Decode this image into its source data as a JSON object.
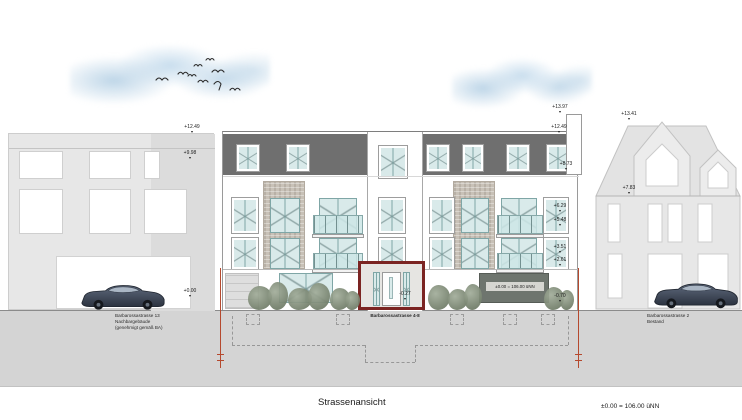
{
  "drawing": {
    "title": "Strassenansicht",
    "datum_note": "±0.00 = 106.00 üNN"
  },
  "neighbor_left": {
    "caption_line1": "Barbarossastrasse 13",
    "caption_line2": "Nachbargebäude",
    "caption_line3": "(genehmigt gemäß BA)",
    "marks": {
      "roof": "+12.49",
      "eave": "+9.98",
      "street": "+0.00"
    }
  },
  "main_building": {
    "caption": "Barbarossastrasse 4-8",
    "ground_floor_datum": "±0.00 = 106.00 üNN",
    "marks": {
      "shaft_top": "+13.97",
      "roof_parapet": "+12.49",
      "attic_eave": "+8.73",
      "window_upper_head": "+6.29",
      "window_upper_sill": "+5.48",
      "window_lower_head": "+3.51",
      "window_lower_sill": "+2.61",
      "base": "-0.70",
      "entrance": "-0.27"
    }
  },
  "neighbor_right": {
    "caption_line1": "Barbarossastrasse 2",
    "caption_line2": "Bestand",
    "marks": {
      "ridge": "+13.41",
      "eave": "+7.83"
    }
  },
  "colors": {
    "attic_floor": "#6f6f6f",
    "window_glass": "#d9eaea",
    "brick": "#c8c1b7",
    "entrance_frame": "#7b2422",
    "boundary_line": "#b5492e",
    "street": "#d4d4d4",
    "neighbor_fill": "#e7e7e7",
    "car_body": "#3c4656"
  }
}
